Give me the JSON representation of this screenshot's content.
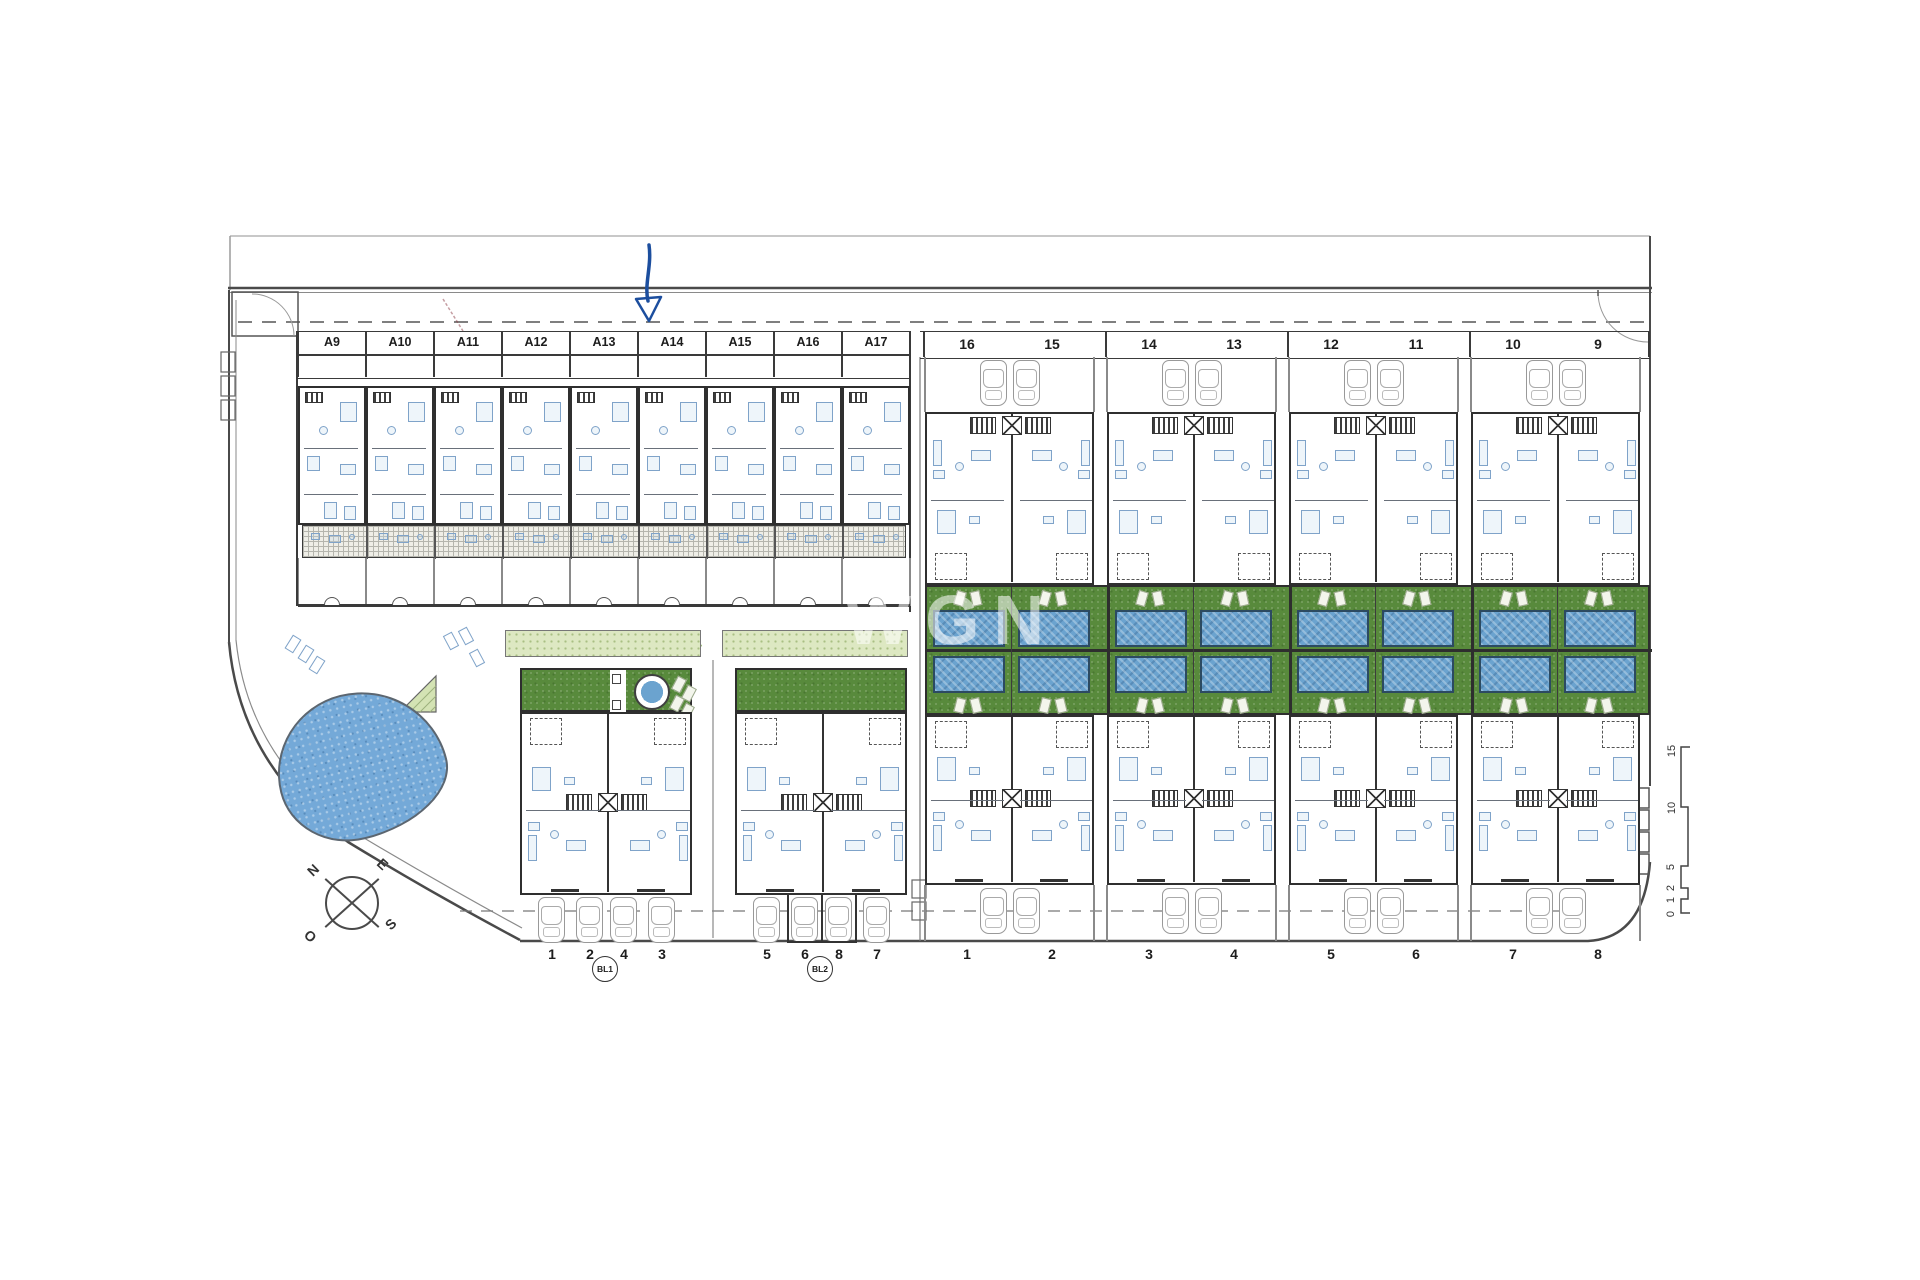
{
  "watermark": {
    "text": "WGN"
  },
  "colors": {
    "line": "#2f2f2f",
    "furniture_blue": "#7fa3c9",
    "garden_green": "#588a3c",
    "palm_strip_green": "#dde8c2",
    "pool_blue": "#6ba3cf",
    "pond_blue": "#74a9d8",
    "arrow_blue": "#1c4e9e"
  },
  "top_road": {
    "row_a_labels": [
      "A9",
      "A10",
      "A11",
      "A12",
      "A13",
      "A14",
      "A15",
      "A16",
      "A17"
    ],
    "row_right_labels": [
      "16",
      "15",
      "14",
      "13",
      "12",
      "11",
      "10",
      "9"
    ]
  },
  "right_section": {
    "bottom_labels": [
      "1",
      "2",
      "3",
      "4",
      "5",
      "6",
      "7",
      "8"
    ]
  },
  "left_bottom": {
    "blocks": [
      {
        "badge": "BL1",
        "labels": [
          "1",
          "2",
          "4",
          "3"
        ]
      },
      {
        "badge": "BL2",
        "labels": [
          "5",
          "6",
          "8",
          "7"
        ]
      }
    ]
  },
  "compass": {
    "north": "N",
    "east": "E",
    "south": "S",
    "west": "O"
  },
  "scale_bar": {
    "major": [
      "15",
      "10",
      "5"
    ],
    "minor": [
      "2",
      "1",
      "0"
    ]
  }
}
